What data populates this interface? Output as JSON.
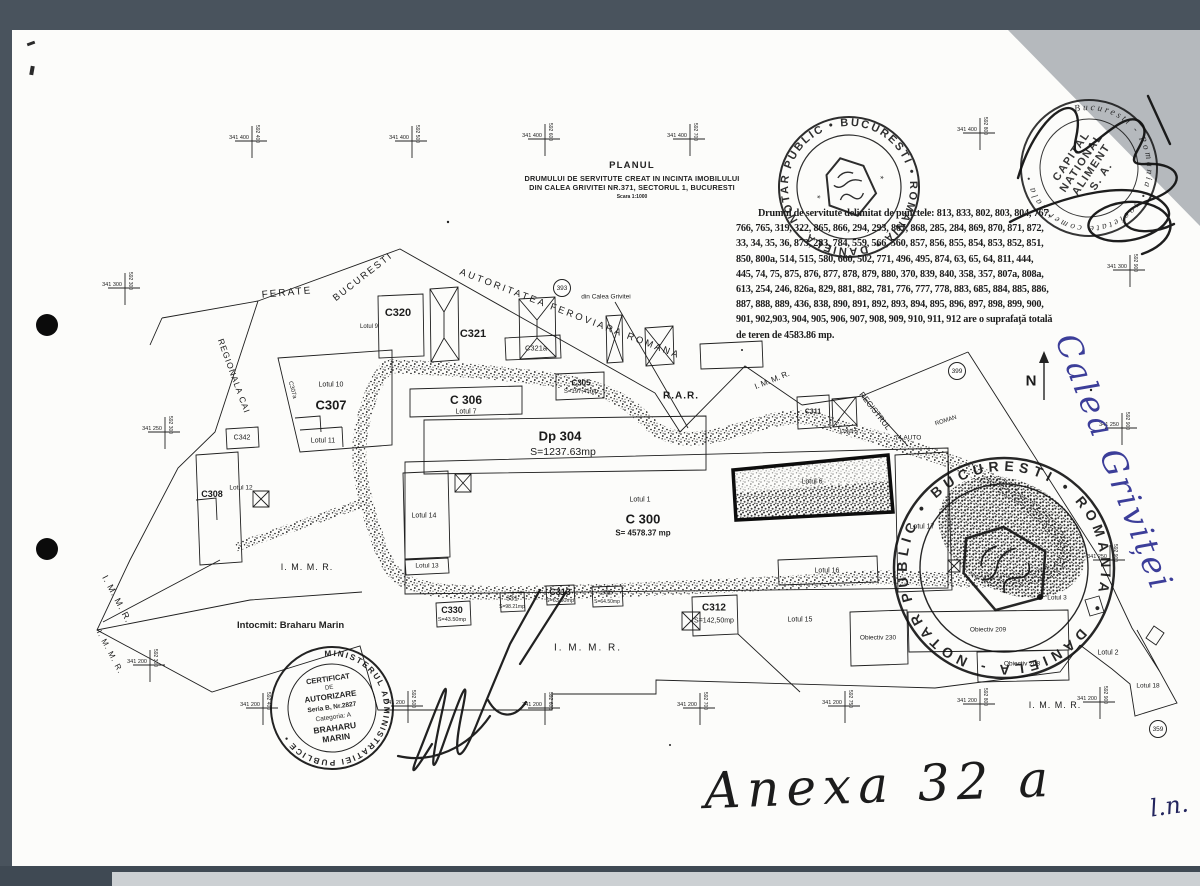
{
  "scan": {
    "frame_color": "#49535d",
    "paper_color": "#fcfcfa",
    "corner_shadow_color": "#b5b9bd",
    "ink_color": "#1b1b1b",
    "blue_ink_color": "#3c3e99"
  },
  "title_block": {
    "heading": "PLANUL",
    "line2": "DRUMULUI DE SERVITUTE CREAT IN INCINTA IMOBILULUI",
    "line3": "DIN CALEA GRIVITEI NR.371, SECTORUL 1, BUCURESTI",
    "scale": "Scara 1:1000"
  },
  "servitude_note": {
    "lines": [
      "Drumul de servitute delimitat de  punctele: 813, 833, 802, 803, 804, 767,",
      "766, 765, 319, 322, 865, 866, 294, 293, 867, 868, 285, 284, 869, 870, 871, 872,",
      "33, 34, 35, 36, 873, 283, 784, 559, 566, 560, 857, 856, 855, 854, 853, 852, 851,",
      "850, 800a, 514, 515, 580, 660, 502, 771, 496, 495, 874, 63, 65, 64, 811, 444,",
      "445, 74, 75, 875, 876, 877, 878, 879, 880, 370, 839, 840, 358, 357, 807a, 808a,",
      "613, 254, 246, 826a, 829, 881, 882, 781, 776, 777, 778, 883, 685, 884, 885, 886,",
      "887, 888, 889, 436, 838, 890, 891, 892,  893, 894, 895, 896, 897, 898, 899, 900,",
      "901, 902,903, 904, 905, 906, 907, 908, 909, 910, 911, 912  are o suprafaţă totală",
      "de teren  de 4583.86 mp."
    ]
  },
  "author_note": "Intocmit: Braharu Marin",
  "handwriting": {
    "street_annotation": "Calea Griviței",
    "annex_label": "Anexa 32 a",
    "corner_initials": "l.n."
  },
  "stamps": {
    "notary_round": {
      "ring_text": "DANIELA - NOTAR PUBLIC • BUCURESTI • ROMANIA •"
    },
    "company_round": {
      "ring_text": "Bucuresti - Romania • societate comerciala •",
      "center_lines": [
        "CAPITAL",
        "NATIONAL",
        "ALIMENT",
        "S. A."
      ]
    },
    "certificate_round": {
      "ring_text": "MINISTERUL ADMINISTRATIEI PUBLICE •",
      "center_lines": [
        "CERTIFICAT",
        "DE",
        "AUTORIZARE",
        "Seria B, Nr.2827",
        "Categoria: A",
        "BRAHARU",
        "MARIN"
      ]
    },
    "notary_round_lower": {
      "ring_text": "DANIELA - NOTAR PUBLIC • BUCURESTI • ROMANIA •"
    }
  },
  "map": {
    "north_label": "N",
    "labels": [
      {
        "t": "FERATE",
        "x": 287,
        "y": 293,
        "s": 10,
        "r": -5,
        "ls": 2
      },
      {
        "t": "BUCURESTI",
        "x": 363,
        "y": 277,
        "s": 9.5,
        "r": -38,
        "ls": 2
      },
      {
        "t": "AUTORITATEA FEROVIARA ROMANA",
        "x": 570,
        "y": 314,
        "s": 9.5,
        "r": 21,
        "ls": 2.5
      },
      {
        "t": "REGIONALA CAI",
        "x": 234,
        "y": 376,
        "s": 8.5,
        "r": 70,
        "ls": 1
      },
      {
        "t": "din Calea Grivitei",
        "x": 606,
        "y": 297,
        "s": 6.5
      },
      {
        "t": "C320",
        "x": 398,
        "y": 313,
        "s": 11,
        "w": 600
      },
      {
        "t": "Lotul 9",
        "x": 369,
        "y": 327,
        "s": 6
      },
      {
        "t": "C321",
        "x": 473,
        "y": 334,
        "s": 11,
        "w": 600
      },
      {
        "t": "C321a",
        "x": 536,
        "y": 348,
        "s": 7.5
      },
      {
        "t": "C305",
        "x": 581,
        "y": 383,
        "s": 8,
        "w": 600
      },
      {
        "t": "S=197,41mp",
        "x": 581,
        "y": 392,
        "s": 6
      },
      {
        "t": "C 306",
        "x": 466,
        "y": 400,
        "s": 12,
        "w": 600
      },
      {
        "t": "Lotul 7",
        "x": 466,
        "y": 412,
        "s": 7
      },
      {
        "t": "Dp 304",
        "x": 560,
        "y": 436,
        "s": 13,
        "w": 600
      },
      {
        "t": "S=1237.63mp",
        "x": 563,
        "y": 452,
        "s": 10.5
      },
      {
        "t": "R.A.R.",
        "x": 681,
        "y": 396,
        "s": 10,
        "w": 600,
        "ls": 1
      },
      {
        "t": "I. M. M. R.",
        "x": 772,
        "y": 380,
        "s": 8,
        "r": -22
      },
      {
        "t": "REGISTRUL",
        "x": 875,
        "y": 411,
        "s": 8,
        "r": 52
      },
      {
        "t": "74 AUTO",
        "x": 908,
        "y": 438,
        "s": 6.5
      },
      {
        "t": "ROMAN",
        "x": 946,
        "y": 421,
        "s": 6,
        "r": -18
      },
      {
        "t": "C311",
        "x": 813,
        "y": 412,
        "s": 7,
        "w": 600
      },
      {
        "t": "Lotul 5",
        "x": 849,
        "y": 432,
        "s": 6
      },
      {
        "t": "Lotul 1",
        "x": 640,
        "y": 500,
        "s": 7
      },
      {
        "t": "C 300",
        "x": 643,
        "y": 519,
        "s": 13,
        "w": 600
      },
      {
        "t": "S= 4578.37 mp",
        "x": 643,
        "y": 533,
        "s": 8,
        "w": 600
      },
      {
        "t": "Lotul 14",
        "x": 424,
        "y": 516,
        "s": 7
      },
      {
        "t": "Lotul 13",
        "x": 427,
        "y": 566,
        "s": 6.5
      },
      {
        "t": "Lotul 6",
        "x": 812,
        "y": 482,
        "s": 7
      },
      {
        "t": "Lotul 16",
        "x": 827,
        "y": 571,
        "s": 7
      },
      {
        "t": "Lotul 17",
        "x": 922,
        "y": 527,
        "s": 7
      },
      {
        "t": "C307",
        "x": 331,
        "y": 405,
        "s": 13,
        "w": 600
      },
      {
        "t": "Lotul 10",
        "x": 331,
        "y": 385,
        "s": 7
      },
      {
        "t": "Lotul 11",
        "x": 323,
        "y": 441,
        "s": 7
      },
      {
        "t": "C307a",
        "x": 292,
        "y": 390,
        "s": 6,
        "r": 75
      },
      {
        "t": "C342",
        "x": 242,
        "y": 438,
        "s": 7
      },
      {
        "t": "Lotul 12",
        "x": 241,
        "y": 488,
        "s": 6.5
      },
      {
        "t": "C308",
        "x": 212,
        "y": 494,
        "s": 9,
        "w": 600
      },
      {
        "t": "C330",
        "x": 452,
        "y": 610,
        "s": 9,
        "w": 600
      },
      {
        "t": "S=43.50mp",
        "x": 452,
        "y": 620,
        "s": 5.5
      },
      {
        "t": "331",
        "x": 512,
        "y": 599,
        "s": 7
      },
      {
        "t": "S=98.21mp",
        "x": 512,
        "y": 607,
        "s": 5
      },
      {
        "t": "C313",
        "x": 560,
        "y": 592,
        "s": 9,
        "w": 600
      },
      {
        "t": "S=63.50mp",
        "x": 560,
        "y": 601,
        "s": 5.5
      },
      {
        "t": "336",
        "x": 607,
        "y": 593,
        "s": 7
      },
      {
        "t": "S=64.50mp",
        "x": 607,
        "y": 602,
        "s": 5
      },
      {
        "t": "C312",
        "x": 714,
        "y": 608,
        "s": 10,
        "w": 600
      },
      {
        "t": "S=142,50mp",
        "x": 714,
        "y": 621,
        "s": 7
      },
      {
        "t": "I. M. M. R.",
        "x": 307,
        "y": 567,
        "s": 9,
        "ls": 1
      },
      {
        "t": "I. M. M. R.",
        "x": 117,
        "y": 599,
        "s": 9,
        "r": 62,
        "ls": 1
      },
      {
        "t": "I. M. M. R.",
        "x": 110,
        "y": 652,
        "s": 8,
        "r": 62,
        "ls": 1
      },
      {
        "t": "I. M. M. R.",
        "x": 588,
        "y": 648,
        "s": 10,
        "ls": 2
      },
      {
        "t": "I. M. M. R.",
        "x": 1055,
        "y": 705,
        "s": 9,
        "ls": 1
      },
      {
        "t": "Lotul 15",
        "x": 800,
        "y": 620,
        "s": 7
      },
      {
        "t": "Obiectiv 230",
        "x": 878,
        "y": 638,
        "s": 6.5
      },
      {
        "t": "Obiectiv 209",
        "x": 988,
        "y": 630,
        "s": 6.5
      },
      {
        "t": "Obiectiv 208",
        "x": 1022,
        "y": 664,
        "s": 6.5
      },
      {
        "t": "Lotul 3",
        "x": 1057,
        "y": 598,
        "s": 6.5
      },
      {
        "t": "Lotul 2",
        "x": 1108,
        "y": 653,
        "s": 7
      },
      {
        "t": "Lotul 18",
        "x": 1148,
        "y": 686,
        "s": 6.5
      },
      {
        "t": "N",
        "x": 1031,
        "y": 381,
        "s": 15,
        "w": 700
      }
    ],
    "circles": [
      {
        "n": "393",
        "x": 562,
        "y": 288
      },
      {
        "n": "399",
        "x": 957,
        "y": 371
      },
      {
        "n": "359",
        "x": 1158,
        "y": 729
      }
    ],
    "crosses": [
      {
        "x": 252,
        "y": 141,
        "h": "341 400",
        "v": "592 400"
      },
      {
        "x": 412,
        "y": 141,
        "h": "341 400",
        "v": "592 500"
      },
      {
        "x": 545,
        "y": 139,
        "h": "341 400",
        "v": "592 600"
      },
      {
        "x": 690,
        "y": 139,
        "h": "341 400",
        "v": "592 700"
      },
      {
        "x": 980,
        "y": 133,
        "h": "341 400",
        "v": "592 800"
      },
      {
        "x": 1130,
        "y": 270,
        "h": "341 300",
        "v": "592 900"
      },
      {
        "x": 125,
        "y": 288,
        "h": "341 300",
        "v": "592 300"
      },
      {
        "x": 165,
        "y": 432,
        "h": "341 250",
        "v": "592 300"
      },
      {
        "x": 1122,
        "y": 428,
        "h": "341 250",
        "v": "592 900"
      },
      {
        "x": 1110,
        "y": 560,
        "h": "341 250",
        "v": "592 900"
      },
      {
        "x": 150,
        "y": 665,
        "h": "341 200",
        "v": "592 300"
      },
      {
        "x": 263,
        "y": 708,
        "h": "341 200",
        "v": "592 400"
      },
      {
        "x": 408,
        "y": 706,
        "h": "341 200",
        "v": "592 500"
      },
      {
        "x": 545,
        "y": 708,
        "h": "341 200",
        "v": "592 600"
      },
      {
        "x": 700,
        "y": 708,
        "h": "341 200",
        "v": "592 700"
      },
      {
        "x": 845,
        "y": 706,
        "h": "341 200",
        "v": "592 750"
      },
      {
        "x": 980,
        "y": 704,
        "h": "341 200",
        "v": "592 800"
      },
      {
        "x": 1100,
        "y": 702,
        "h": "341 200",
        "v": "592 900"
      }
    ]
  }
}
